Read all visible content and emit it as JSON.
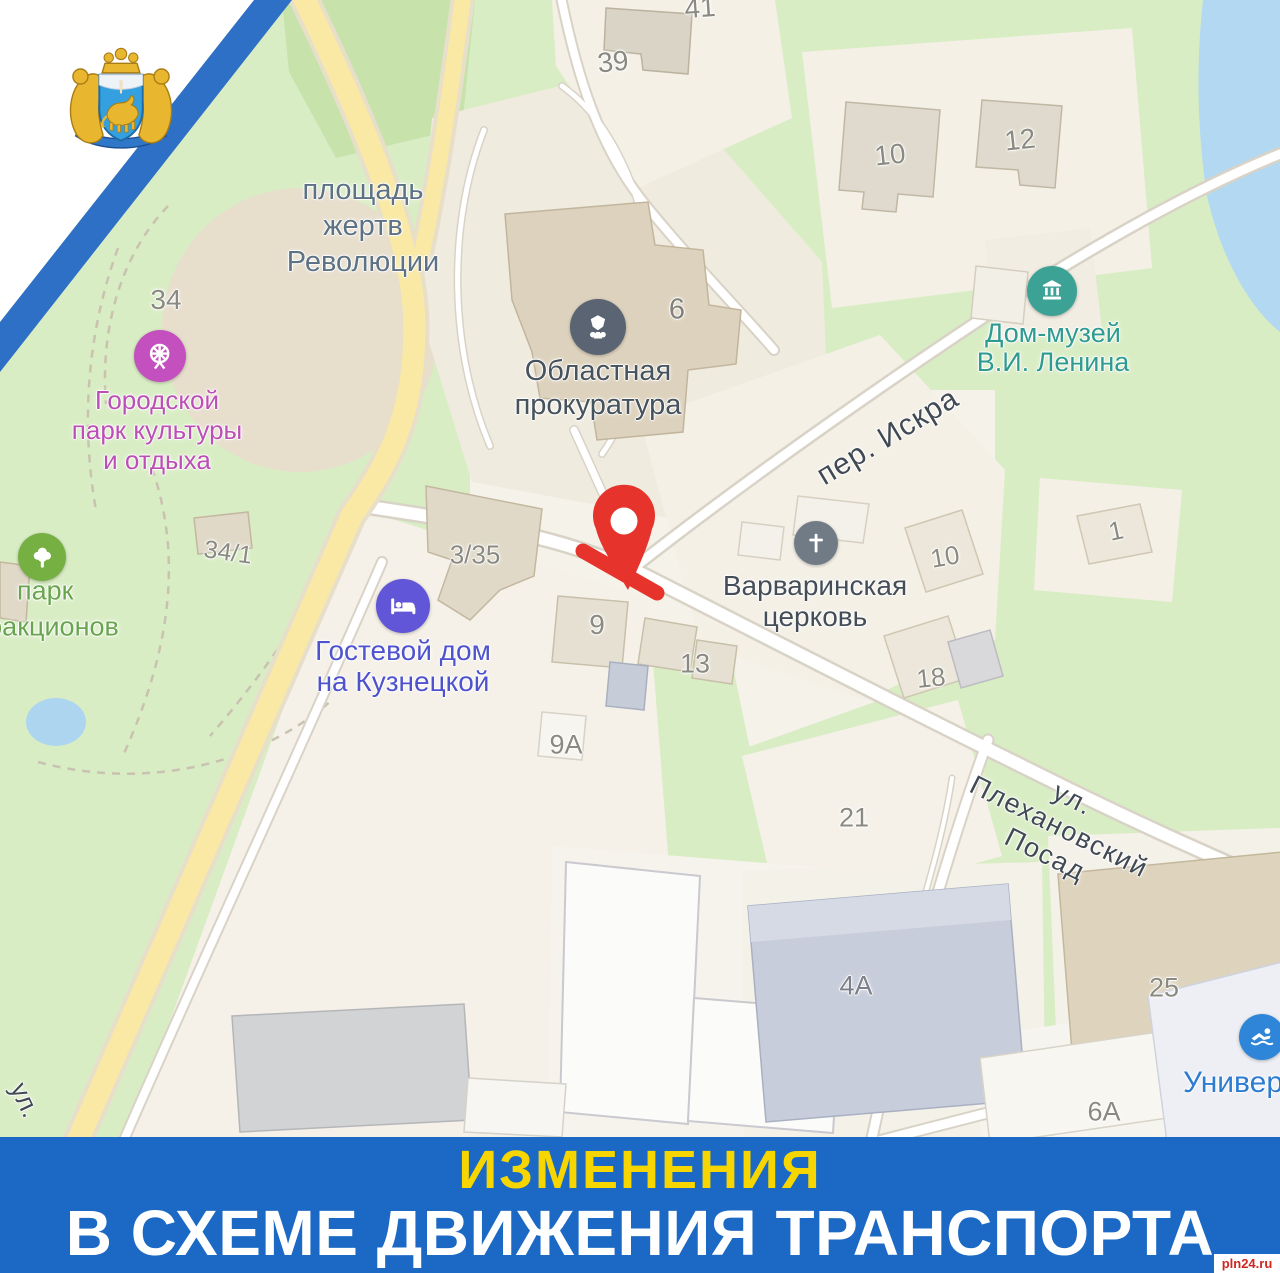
{
  "poster": {
    "banner": {
      "line1": "ИЗМЕНЕНИЯ",
      "line2": "В СХЕМЕ ДВИЖЕНИЯ ТРАНСПОРТА",
      "bg_color": "#1b69c5",
      "line1_color": "#f7d600",
      "line2_color": "#ffffff"
    },
    "watermark": "pln24.ru",
    "emblem": "pskov-region-coat-of-arms"
  },
  "map": {
    "labels": [
      {
        "name": "label-ploshchad-zhertv-revolyutsii",
        "text": "площадь\nжертв\nРеволюции",
        "x": 363,
        "y": 226,
        "size": 29,
        "lh": 36,
        "color": "#5e7285"
      },
      {
        "name": "number-34",
        "text": "34",
        "x": 166,
        "y": 300,
        "size": 28,
        "color": "#8a8a82"
      },
      {
        "name": "label-gorodskoy-park",
        "text": "Городской\nпарк культуры\nи отдыха",
        "x": 157,
        "y": 430,
        "size": 26,
        "lh": 30,
        "color": "#bc4fb6"
      },
      {
        "name": "number-34-1",
        "text": "34/1",
        "x": 228,
        "y": 553,
        "size": 25,
        "color": "#8a8a82",
        "rotate": 8
      },
      {
        "name": "label-park",
        "text": "парк",
        "x": 17,
        "y": 591,
        "size": 27,
        "color": "#69a44e",
        "anchor": "left"
      },
      {
        "name": "label-attrakcionov",
        "text": "аттракционов",
        "x": -52,
        "y": 627,
        "size": 27,
        "color": "#69a44e",
        "anchor": "left"
      },
      {
        "name": "label-oblastnaya-prokuratura",
        "text": "Областная\nпрокуратура",
        "x": 598,
        "y": 388,
        "size": 29,
        "lh": 34,
        "color": "#46525c"
      },
      {
        "name": "number-6",
        "text": "6",
        "x": 677,
        "y": 310,
        "size": 29,
        "color": "#82827a"
      },
      {
        "name": "label-dom-muzey-lenina",
        "text": "Дом-музей\nВ.И. Ленина",
        "x": 1053,
        "y": 348,
        "size": 27,
        "lh": 29,
        "color": "#2f9a90"
      },
      {
        "name": "street-per-iskra",
        "text": "пер. Искра",
        "x": 888,
        "y": 437,
        "size": 30,
        "color": "#414a54",
        "rotate": -31,
        "ls": 1
      },
      {
        "name": "label-varvarinskaya-tserkov",
        "text": "Варваринская\nцерковь",
        "x": 815,
        "y": 601,
        "size": 28,
        "lh": 31,
        "color": "#454e58"
      },
      {
        "name": "label-gostevoy-dom",
        "text": "Гостевой дом\nна Кузнецкой",
        "x": 403,
        "y": 666,
        "size": 28,
        "lh": 31,
        "color": "#4f52cd"
      },
      {
        "name": "number-3-35",
        "text": "3/35",
        "x": 475,
        "y": 555,
        "size": 26,
        "color": "#8a8a82"
      },
      {
        "name": "number-9",
        "text": "9",
        "x": 597,
        "y": 625,
        "size": 28,
        "color": "#8a8a82"
      },
      {
        "name": "number-13",
        "text": "13",
        "x": 695,
        "y": 664,
        "size": 27,
        "color": "#8a8a82"
      },
      {
        "name": "number-9a",
        "text": "9А",
        "x": 566,
        "y": 745,
        "size": 27,
        "color": "#8a8a82"
      },
      {
        "name": "number-39",
        "text": "39",
        "x": 613,
        "y": 62,
        "size": 28,
        "color": "#8a8a82",
        "rotate": -6
      },
      {
        "name": "number-41",
        "text": "41",
        "x": 700,
        "y": 8,
        "size": 28,
        "color": "#8a8a82",
        "rotate": -4
      },
      {
        "name": "number-10-top",
        "text": "10",
        "x": 890,
        "y": 155,
        "size": 28,
        "color": "#8a8a82",
        "rotate": -6
      },
      {
        "name": "number-12",
        "text": "12",
        "x": 1020,
        "y": 140,
        "size": 28,
        "color": "#8a8a82",
        "rotate": -6
      },
      {
        "name": "number-10-mid",
        "text": "10",
        "x": 945,
        "y": 557,
        "size": 26,
        "color": "#8a8a82",
        "rotate": -10
      },
      {
        "name": "number-1",
        "text": "1",
        "x": 1116,
        "y": 531,
        "size": 26,
        "color": "#8a8a82",
        "rotate": -12
      },
      {
        "name": "number-18",
        "text": "18",
        "x": 931,
        "y": 678,
        "size": 26,
        "color": "#8a8a82",
        "rotate": -6
      },
      {
        "name": "number-21",
        "text": "21",
        "x": 854,
        "y": 818,
        "size": 27,
        "color": "#8a8a82"
      },
      {
        "name": "street-plekhanovskiy-posad",
        "text": "ул. Плехановский Посад",
        "x": 1059,
        "y": 827,
        "size": 27,
        "color": "#414a54",
        "rotate": 26.5,
        "ls": 1.5
      },
      {
        "name": "number-4a",
        "text": "4А",
        "x": 856,
        "y": 986,
        "size": 27,
        "color": "#7d8089"
      },
      {
        "name": "number-25",
        "text": "25",
        "x": 1164,
        "y": 988,
        "size": 27,
        "color": "#8a8a82"
      },
      {
        "name": "number-6a",
        "text": "6А",
        "x": 1104,
        "y": 1112,
        "size": 27,
        "color": "#8a8a82"
      },
      {
        "name": "street-ul",
        "text": "ул.",
        "x": 25,
        "y": 1100,
        "size": 26,
        "color": "#414a54",
        "rotate": 65
      },
      {
        "name": "label-univer",
        "text": "Универ",
        "x": 1183,
        "y": 1083,
        "size": 30,
        "color": "#2e7cd0",
        "anchor": "left"
      }
    ],
    "pois": [
      {
        "name": "amusement-park-icon",
        "type": "attraction",
        "x": 160,
        "y": 356,
        "d": 52,
        "color": "#c44fbe"
      },
      {
        "name": "park-tree-icon",
        "type": "tree",
        "x": 42,
        "y": 557,
        "d": 48,
        "color": "#76b043"
      },
      {
        "name": "prosecutor-office-icon",
        "type": "prosecutor",
        "x": 598,
        "y": 327,
        "d": 56,
        "color": "#5a6472"
      },
      {
        "name": "museum-icon",
        "type": "museum",
        "x": 1052,
        "y": 291,
        "d": 50,
        "color": "#3da296"
      },
      {
        "name": "church-icon",
        "type": "church",
        "x": 816,
        "y": 543,
        "d": 44,
        "color": "#717b85"
      },
      {
        "name": "hotel-icon",
        "type": "hotel",
        "x": 403,
        "y": 606,
        "d": 54,
        "color": "#6156d8"
      },
      {
        "name": "sport-icon",
        "type": "sport",
        "x": 1262,
        "y": 1037,
        "d": 46,
        "color": "#2f86d8"
      }
    ],
    "closure": {
      "color": "#e6332b",
      "line": {
        "x1": 583,
        "y1": 551,
        "x2": 657,
        "y2": 593,
        "width": 15
      },
      "pin": {
        "x": 624,
        "y": 521
      }
    }
  }
}
